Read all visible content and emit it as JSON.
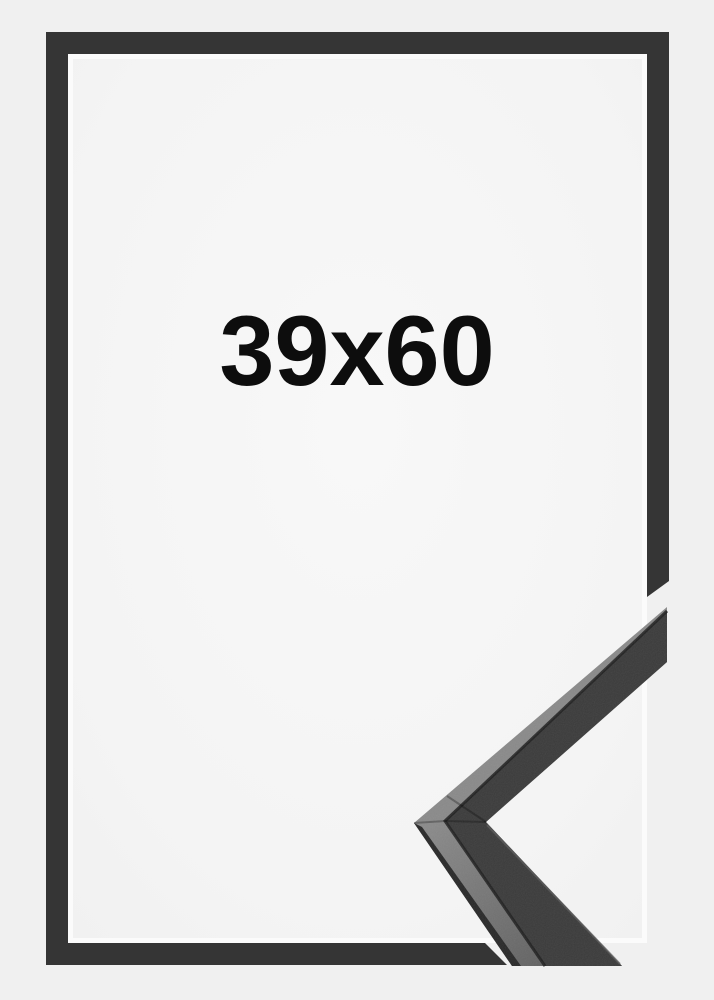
{
  "product": {
    "size_label": "39x60"
  },
  "colors": {
    "background": "#F0F0F0",
    "opening_center": "#F8F8F8",
    "opening_mid": "#F4F4F4",
    "opening_edge": "#F1F1F1",
    "opening_edge_highlight": "#FBFBFB",
    "frame_bar": "#353535",
    "moulding_front": "#3B3B3B",
    "moulding_top_near": "#8A8A8A",
    "moulding_top_far": "#636363",
    "moulding_side": "#292929",
    "moulding_edge_shadow": "#1E1E1E",
    "moulding_inner_highlight": "#5C5C5C",
    "label_text": "#0D0D0D"
  }
}
